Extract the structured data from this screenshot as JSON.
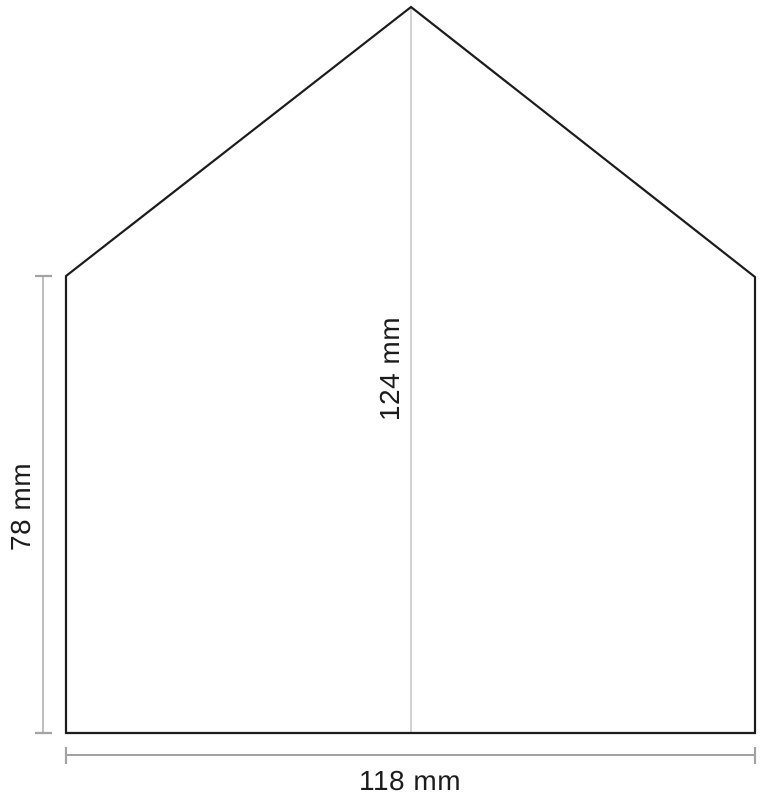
{
  "diagram": {
    "type": "technical-dimension-drawing",
    "shape": "house-pentagon-outline",
    "dimensions": {
      "left_height": "78 mm",
      "center_height": "124 mm",
      "bottom_width": "118 mm"
    },
    "colors": {
      "background": "#ffffff",
      "outline": "#1c1c1c",
      "dimension_line": "#a3a3a3",
      "centerline": "#b3b3b3",
      "label_text": "#1c1c1c"
    }
  }
}
